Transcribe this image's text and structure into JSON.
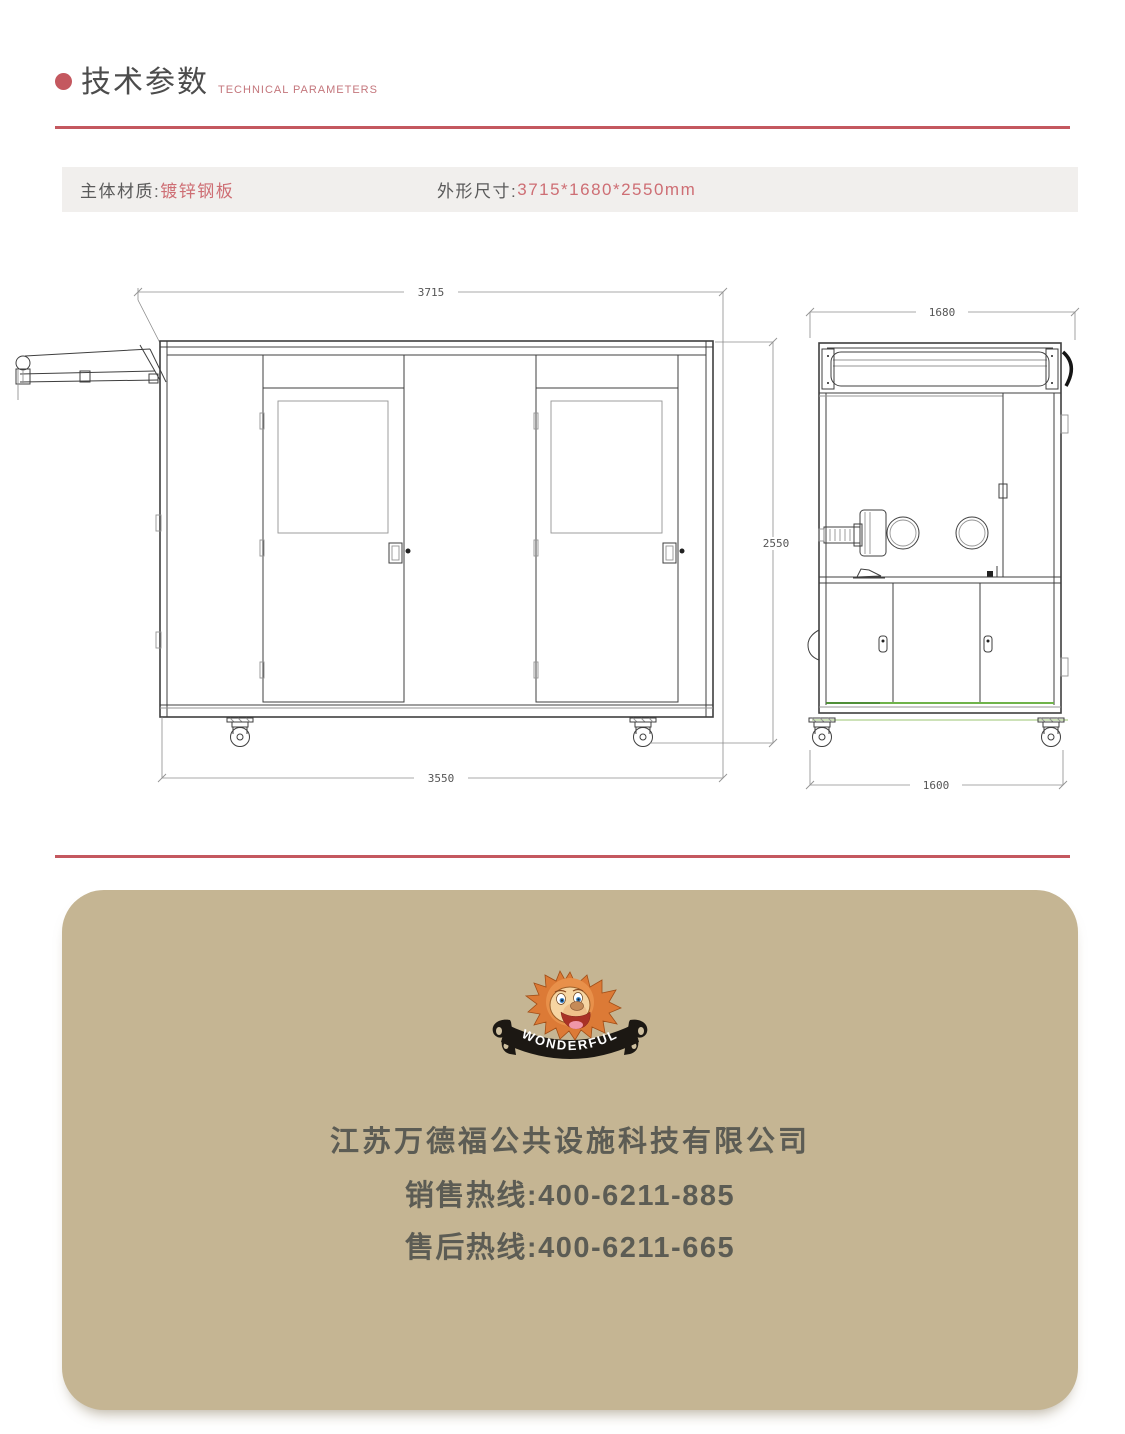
{
  "theme": {
    "accent_red": "#c4585f",
    "text_red": "#ce6e74",
    "title_gray": "#4c4c4c",
    "bar_bg": "#f1efed",
    "card_tan": "#c5b593",
    "footer_text": "#5c5c54",
    "drawing_green": "#6fb34a",
    "drawing_green_light": "#cde2b8"
  },
  "header": {
    "title": "技术参数",
    "subtitle": "TECHNICAL PARAMETERS"
  },
  "specs": {
    "material_label": "主体材质:",
    "material_value": "镀锌钢板",
    "size_label": "外形尺寸:",
    "size_value": "3715*1680*2550mm"
  },
  "drawing": {
    "front_width_mm": "3715",
    "front_base_mm": "3550",
    "height_mm": "2550",
    "side_width_mm": "1680",
    "side_base_mm": "1600"
  },
  "footer": {
    "ribbon_text": "WONDERFUL",
    "company_name": "江苏万德福公共设施科技有限公司",
    "sales_hotline": "销售热线:400-6211-885",
    "aftersales_hotline": "售后热线:400-6211-665"
  }
}
